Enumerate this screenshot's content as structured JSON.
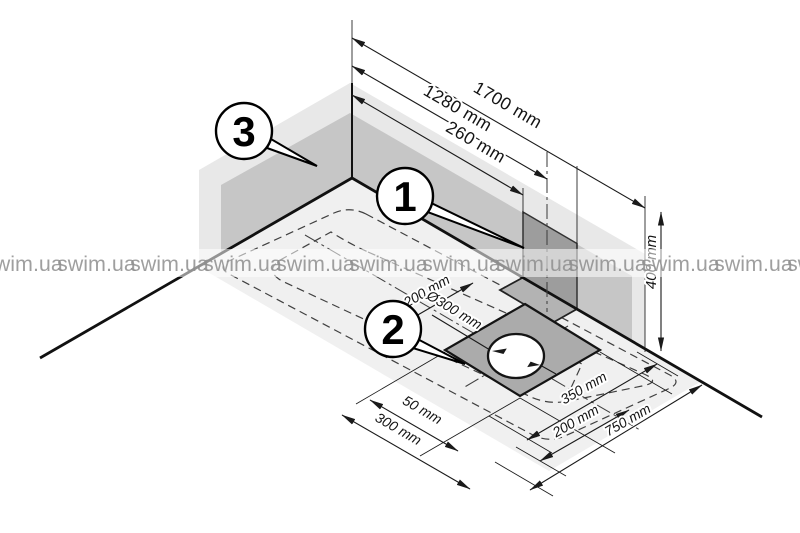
{
  "diagram": {
    "callouts": {
      "c1": "1",
      "c2": "2",
      "c3": "3"
    },
    "dims": {
      "top1": "1700 mm",
      "top2": "1280 mm",
      "top3": "260 mm",
      "height": "400 mm",
      "depth": "200 mm",
      "diameter": "Ø300 mm",
      "bl1": "50 mm",
      "bl2": "300 mm",
      "br1": "350 mm",
      "br2": "200 mm",
      "br3": "750 mm"
    },
    "watermark": "swim.ua"
  }
}
